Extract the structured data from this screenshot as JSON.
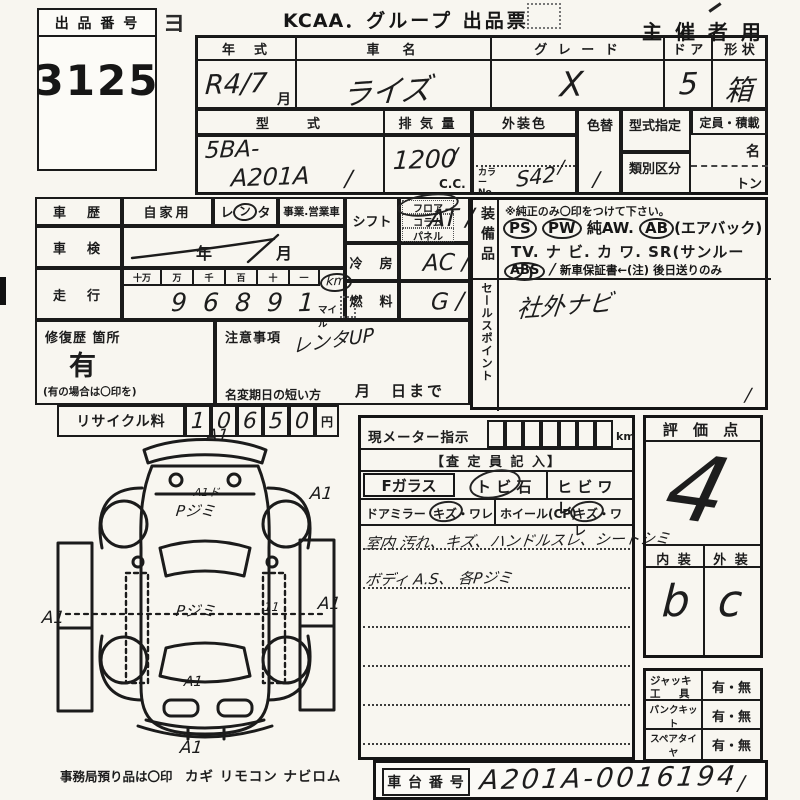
{
  "lot": {
    "label": "出 品 番 号",
    "number": "3125"
  },
  "header": {
    "logo": "KCAA",
    "title": "．グループ 出品票",
    "right": "主 催 者 用",
    "stray_mark": "ヨ"
  },
  "vehicle": {
    "year_label": "年　式",
    "year_value": "R4/7",
    "month_suffix": "月",
    "name_label": "車　名",
    "name_value": "ライズ",
    "grade_label": "グ レ ー ド",
    "grade_value": "X",
    "door_label": "ド ア",
    "door_value": "5",
    "shape_label": "形 状",
    "shape_value": "箱",
    "model_label": "型　　式",
    "model_line1": "5BA-",
    "model_line2": "A201A",
    "model_slash": "/",
    "disp_label": "排 気 量",
    "disp_value": "1200",
    "disp_slash": "/",
    "disp_unit": "C.C.",
    "color_label": "外装色",
    "color_no_label": "カラーNo.",
    "color_value": "S42",
    "color_slash": "/",
    "recolor_label": "色替",
    "recolor_value": "/",
    "type_desig_label": "型式指定",
    "class_label": "類別区分",
    "capacity_label": "定員・積載",
    "capacity_persons": "名",
    "capacity_tons": "トン"
  },
  "history": {
    "label": "車　歴",
    "private": "自家用",
    "rental_a": "レ",
    "rental_b": "ン",
    "rental_c": "タ",
    "business": "事業.営業車",
    "inspection_label": "車　検",
    "inspection_year": "年",
    "inspection_month": "月",
    "mileage_label": "走　行",
    "units": [
      "十万",
      "万",
      "千",
      "百",
      "十",
      "一"
    ],
    "digits": [
      "",
      "9",
      "6",
      "8",
      "9",
      "1"
    ],
    "km": "km",
    "mile": "マイル"
  },
  "repair": {
    "label": "修復歴 箇所",
    "value": "有",
    "note": "(有の場合は〇印を)"
  },
  "caution": {
    "label": "注意事項",
    "value": "レンタUP",
    "rename_label": "名変期日の短い方",
    "date_suffix": "月　日まで"
  },
  "recycle": {
    "label": "リサイクル料",
    "digits": [
      "1",
      "0",
      "6",
      "5",
      "0"
    ],
    "unit": "円"
  },
  "drivetrain": {
    "shift_label": "シフト",
    "shift_opt1": "フロア",
    "shift_opt2": "コラム",
    "shift_opt3": "パネル",
    "shift_value": "AT /",
    "ac_label": "冷　房",
    "ac_value": "AC /",
    "fuel_label": "燃　料",
    "fuel_value": "G /"
  },
  "equipment": {
    "label": "装備品",
    "note": "※純正のみ〇印をつけて下さい。",
    "ps": "PS",
    "pw": "PW",
    "aw": "純AW.",
    "ab": "AB",
    "ab_note": "(エアバック)",
    "line2": "TV. ナ ビ. カ ワ. SR(サンルーフ)",
    "abs": "ABS",
    "slash": "/",
    "warranty": "新車保証書←(注) 後日送りのみ"
  },
  "sales_point": {
    "label": "セールスポイント",
    "value": "社外ナビ",
    "corner_slash": "/"
  },
  "meter": {
    "label": "現メーター指示",
    "unit": "km",
    "assessor": "【査 定 員 記 入】",
    "fglass": "Fガラス",
    "stone": "ト ビ 石",
    "crack": "ヒ ビ ワ レ",
    "mirror": "ドアミラー",
    "mirror_dmg": "キズ・ワレ",
    "wheel": "ホイール(CP)",
    "wheel_dmg": "キズ・ワレ",
    "note1": "室内 汚れ、キズ、ハンドルスレ、シートシミ",
    "note2": "ボディ A.S、 各Pジミ"
  },
  "score": {
    "label": "評 価 点",
    "value": "4",
    "interior_label": "内 装",
    "exterior_label": "外 装",
    "interior": "b",
    "exterior": "c"
  },
  "tools": {
    "rows": [
      {
        "line1": "ジャッキ",
        "line2": "工　具",
        "value": "有・無"
      },
      {
        "line1": "パンクキット",
        "line2": "",
        "value": "有・無"
      },
      {
        "line1": "スペアタイヤ",
        "line2": "",
        "value": "有・無"
      }
    ]
  },
  "footer": {
    "office_note": "事務局預り品は〇印",
    "items": "カギ  リモコン  ナビロム",
    "chassis_label": "車 台 番 号",
    "chassis_value": "A201A-0016194",
    "chassis_slash": "/"
  },
  "diagram": {
    "marks": [
      {
        "text": "A1"
      },
      {
        "text": "A1"
      },
      {
        "text": "A1ド"
      },
      {
        "text": "Pジミ"
      },
      {
        "text": "Pジミ"
      },
      {
        "text": "A1"
      },
      {
        "text": "A1"
      },
      {
        "text": "11"
      },
      {
        "text": "A1"
      },
      {
        "text": "A1"
      }
    ]
  }
}
